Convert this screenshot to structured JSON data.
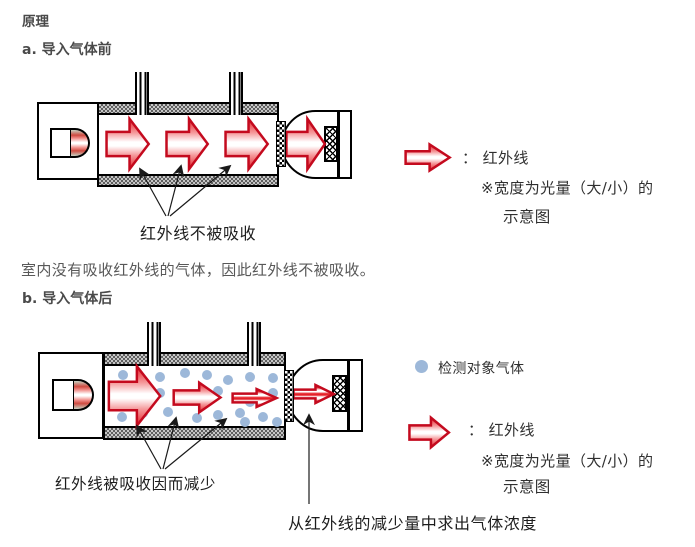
{
  "title": "原理",
  "section_a": {
    "heading": "a. 导入气体前",
    "annotation": "红外线不被吸收",
    "legend": {
      "ir_label": "： 红外线",
      "ir_note_line1": "※宽度为光量（大/小）的",
      "ir_note_line2": "示意图"
    }
  },
  "paragraph": "室内没有吸收红外线的气体，因此红外线不被吸收。",
  "section_b": {
    "heading": "b. 导入气体后",
    "annotation_absorbed": "红外线被吸收因而减少",
    "annotation_concentration": "从红外线的减少量中求出气体浓度",
    "legend": {
      "gas_label": "检测对象气体",
      "ir_label": "： 红外线",
      "ir_note_line1": "※宽度为光量（大/小）的",
      "ir_note_line2": "示意图"
    },
    "gas_dots": [
      [
        123,
        375
      ],
      [
        160,
        377
      ],
      [
        185,
        373
      ],
      [
        207,
        375
      ],
      [
        228,
        380
      ],
      [
        250,
        377
      ],
      [
        273,
        378
      ],
      [
        160,
        393
      ],
      [
        218,
        391
      ],
      [
        273,
        393
      ],
      [
        250,
        402
      ],
      [
        122,
        417
      ],
      [
        143,
        413
      ],
      [
        168,
        412
      ],
      [
        197,
        418
      ],
      [
        218,
        415
      ],
      [
        240,
        413
      ],
      [
        245,
        422
      ],
      [
        263,
        417
      ],
      [
        277,
        422
      ]
    ]
  },
  "colors": {
    "infrared_red": "#e62129",
    "arrow_outline_red": "#c40a1e",
    "gas_molecule_blue": "#9db8d9",
    "heading_text": "#4a4a4a",
    "body_text": "#585858",
    "label_text": "#1d1d1d"
  }
}
